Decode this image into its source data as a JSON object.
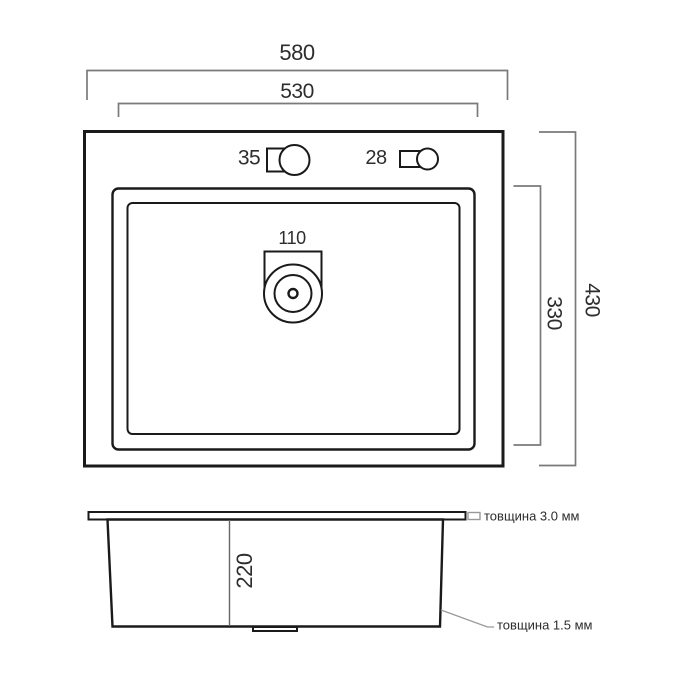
{
  "drawing": {
    "type": "sink-technical-drawing",
    "colors": {
      "object_line": "#1a1a1a",
      "dimension_line": "#7a7a7a",
      "text": "#2d2d2d",
      "background": "#ffffff"
    },
    "top_view": {
      "outer_width": "580",
      "bowl_width": "530",
      "outer_depth": "430",
      "bowl_depth": "330",
      "faucet_hole_diameter": "35",
      "accessory_hole_diameter": "28",
      "drain_hole_diameter": "110"
    },
    "side_view": {
      "bowl_height": "220",
      "rim_thickness_note": "товщина 3.0 мм",
      "wall_thickness_note": "товщина 1.5 мм"
    }
  }
}
